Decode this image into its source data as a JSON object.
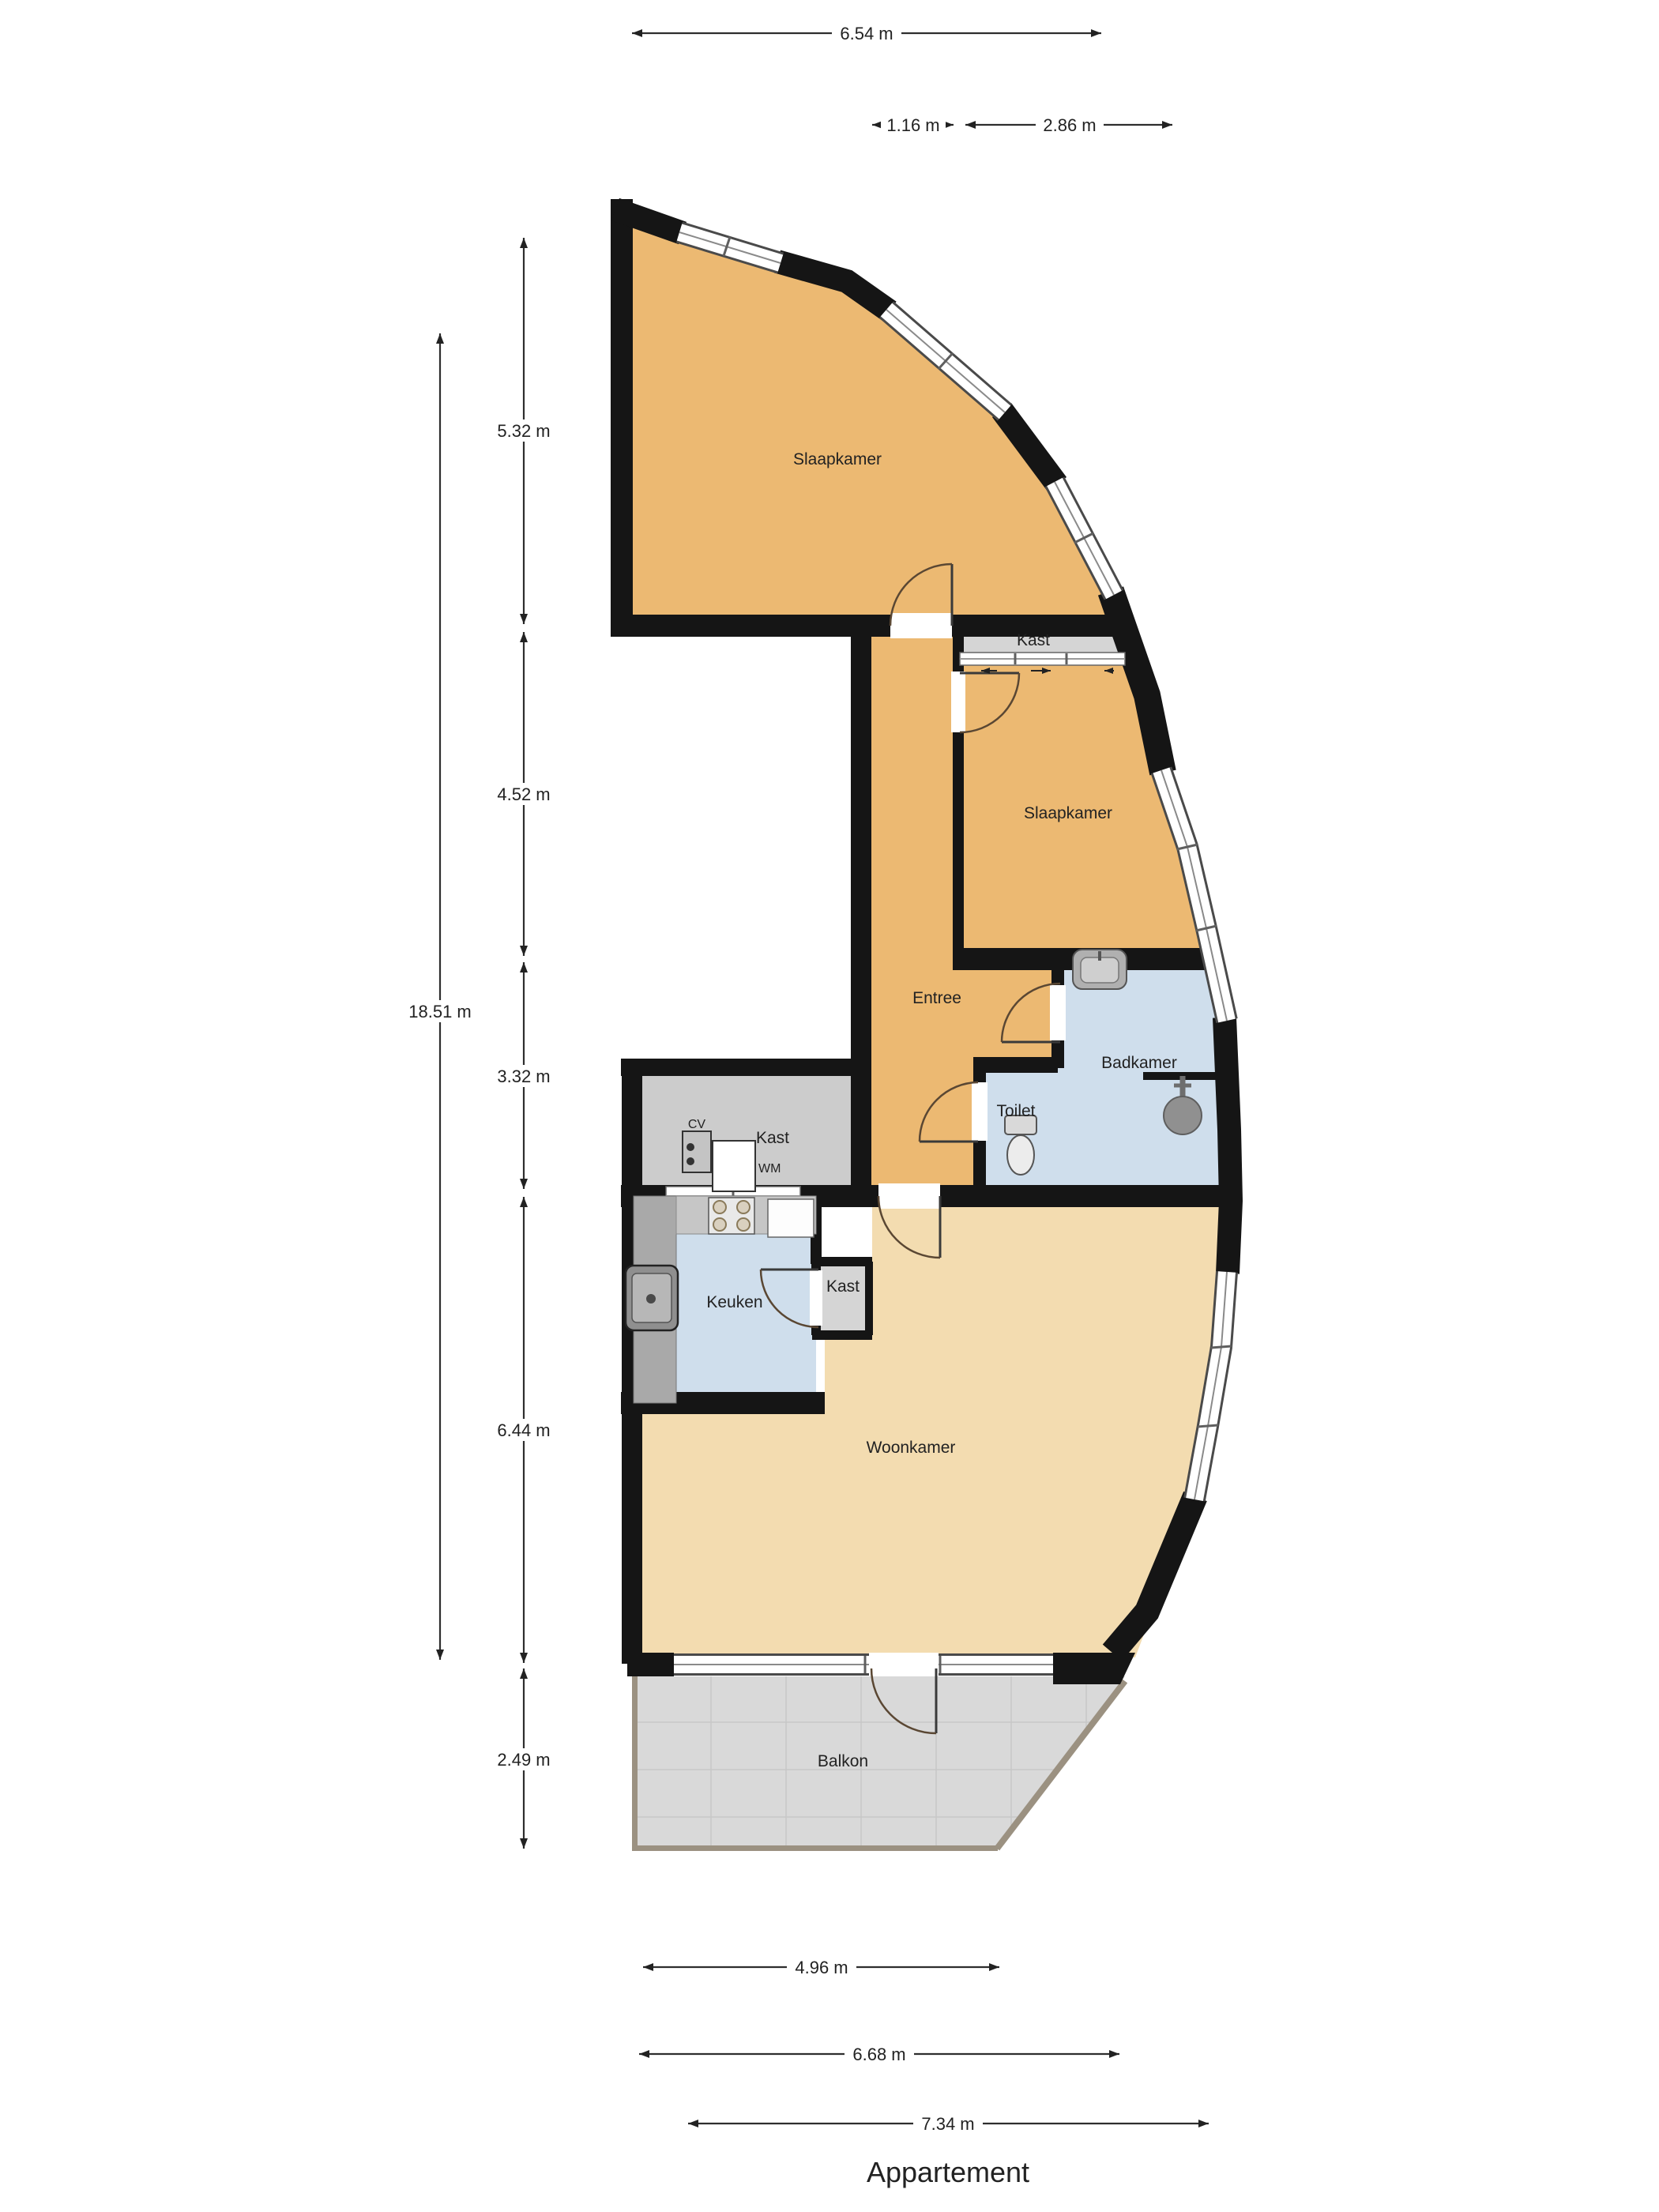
{
  "title": "Appartement",
  "rooms": {
    "slaapkamer1": {
      "label": "Slaapkamer"
    },
    "slaapkamer2": {
      "label": "Slaapkamer"
    },
    "kast_top": {
      "label": "Kast"
    },
    "entree": {
      "label": "Entree"
    },
    "badkamer": {
      "label": "Badkamer"
    },
    "toilet": {
      "label": "Toilet"
    },
    "kast_utility": {
      "label": "Kast"
    },
    "cv": {
      "label": "CV"
    },
    "wm": {
      "label": "WM"
    },
    "keuken": {
      "label": "Keuken"
    },
    "kast_keuken": {
      "label": "Kast"
    },
    "woonkamer": {
      "label": "Woonkamer"
    },
    "balkon": {
      "label": "Balkon"
    }
  },
  "dimensions": {
    "top_width": "6.54 m",
    "hall_width": "1.16 m",
    "bedroom2_width": "2.86 m",
    "total_height": "18.51 m",
    "bedroom1_height": "5.32 m",
    "bedroom2_height": "4.52 m",
    "hall_height": "3.32 m",
    "woonkamer_height": "6.44 m",
    "balkon_height": "2.49 m",
    "balkon_width": "4.96 m",
    "woonkamer_width": "6.68 m",
    "bottom_width": "7.34 m"
  },
  "colors": {
    "bedroom_orange": "#ecb972",
    "living_beige": "#f3dcb0",
    "wet_blue": "#cfdeec",
    "closet_gray": "#cccccc",
    "closet_light_gray": "#d5d5d5",
    "balcony_gray": "#d9d9d9",
    "wall_black": "#151515"
  }
}
